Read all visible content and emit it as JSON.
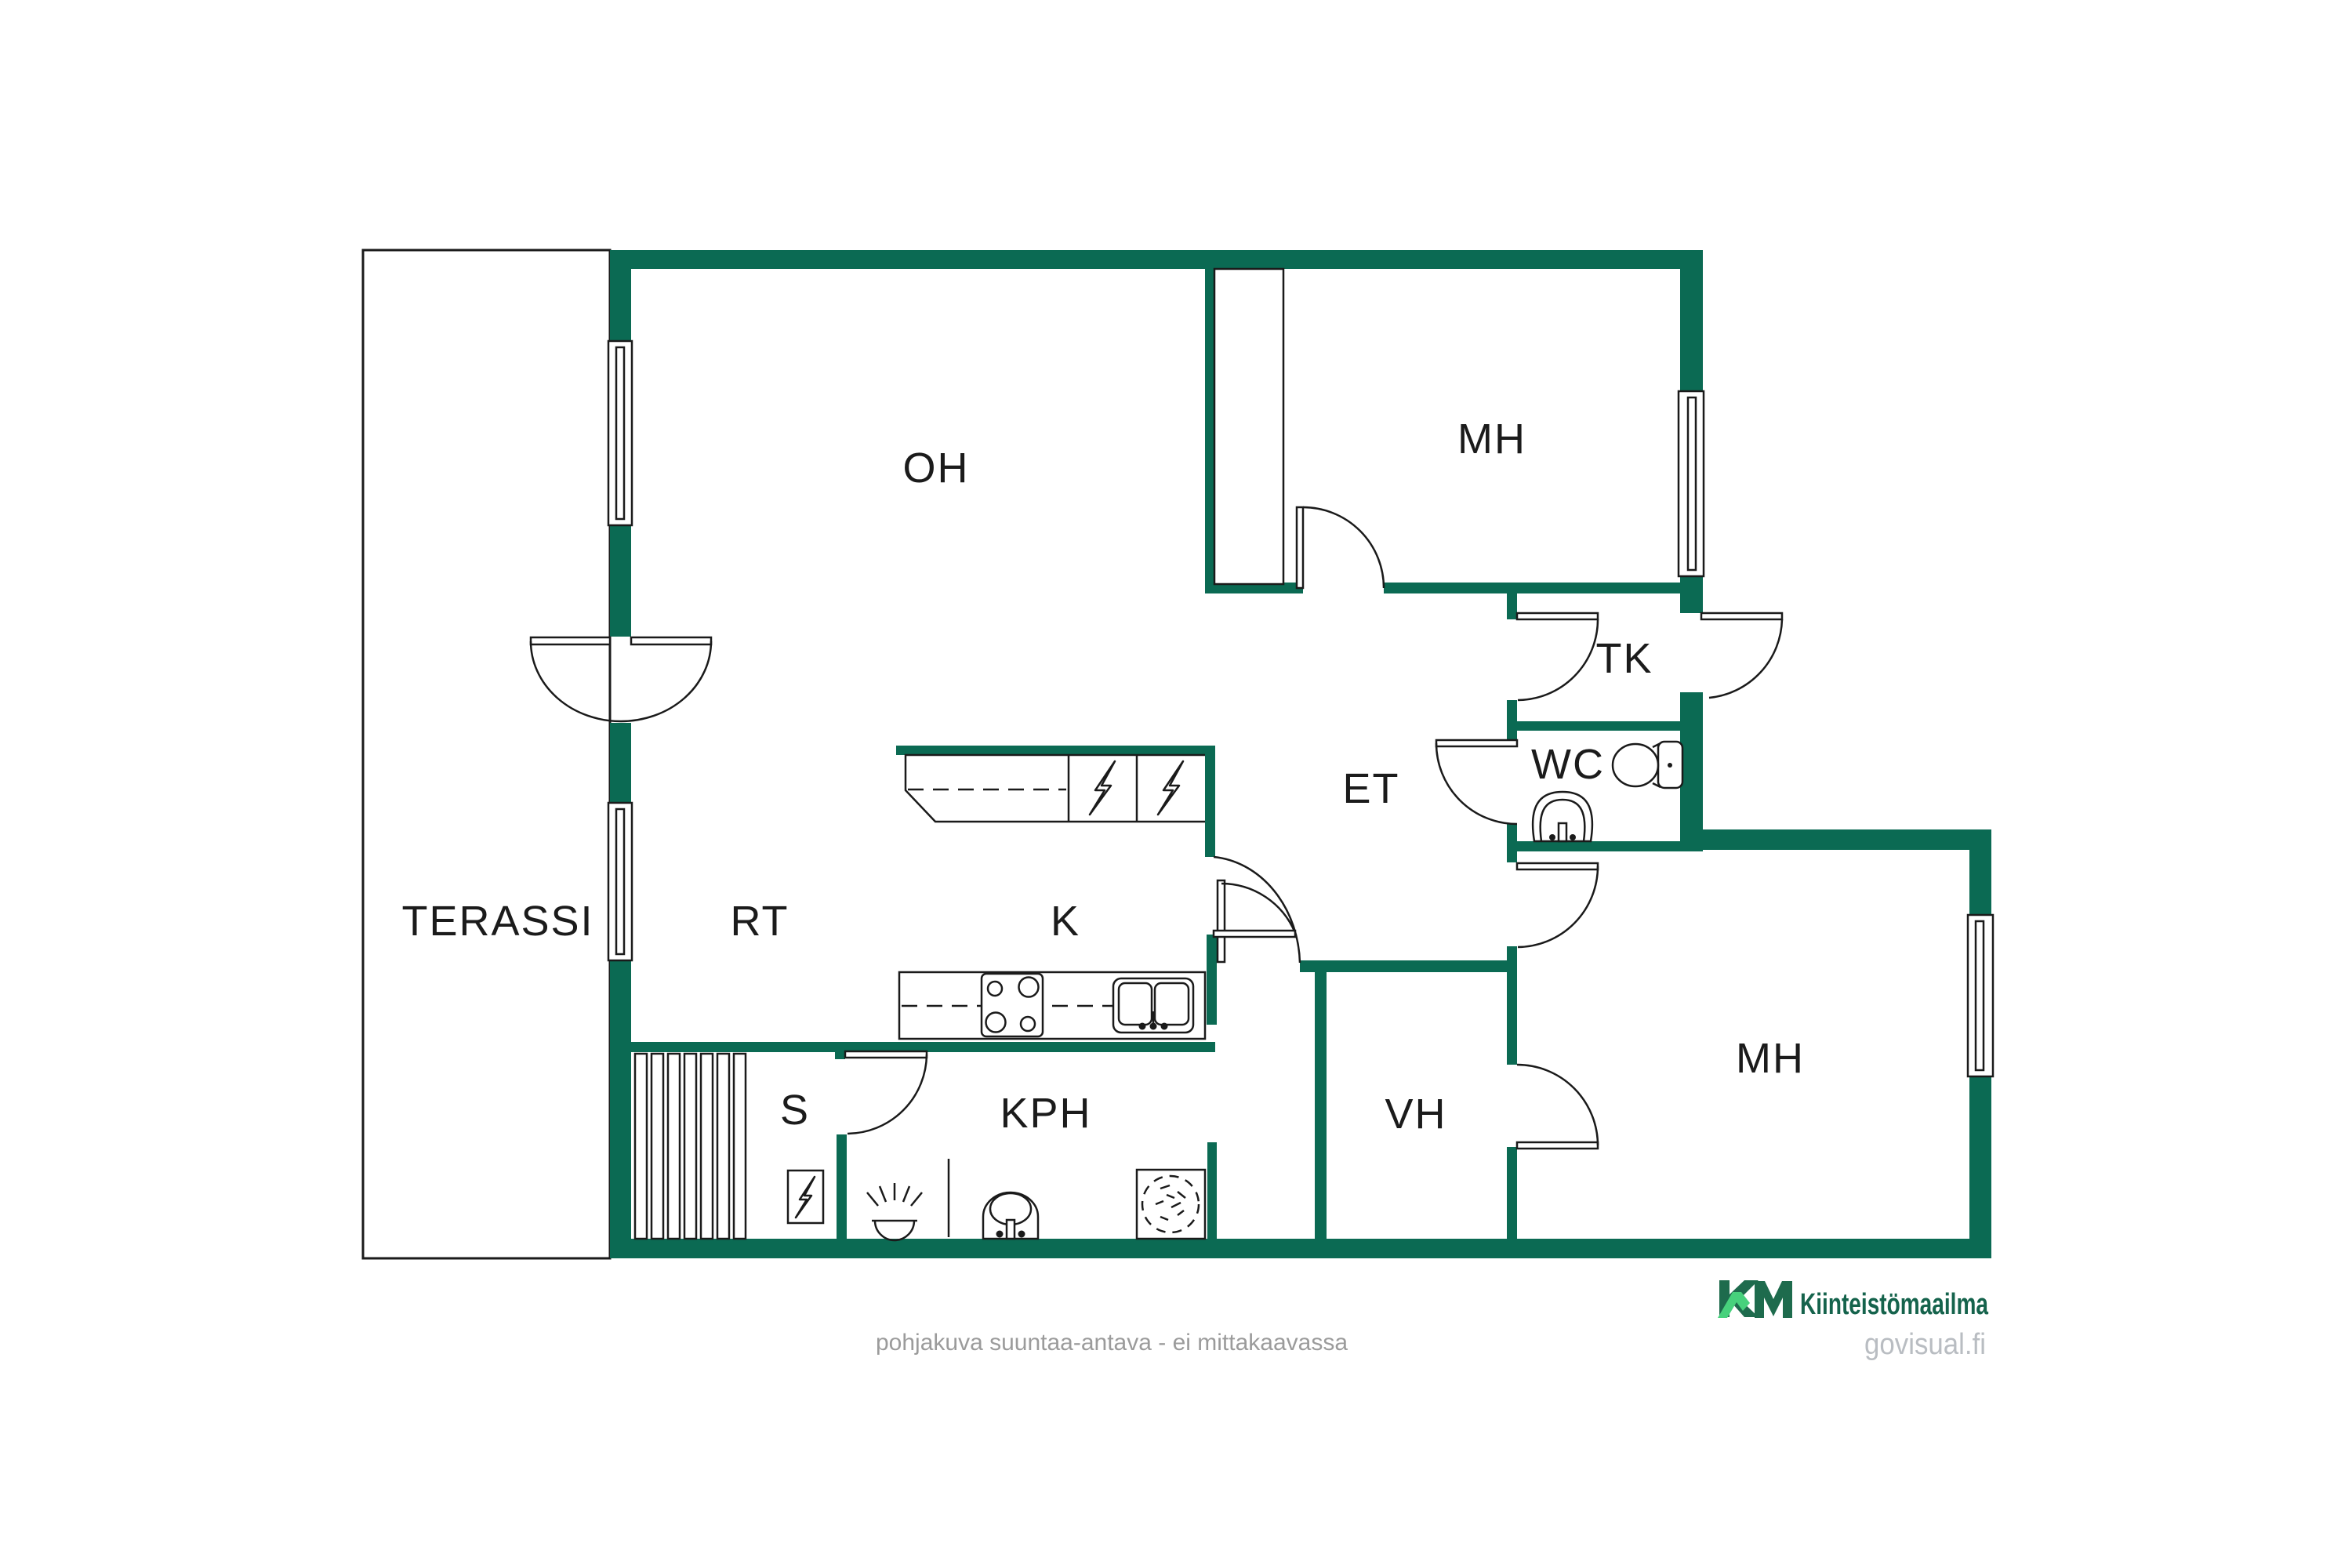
{
  "colors": {
    "wall": "#0b6a53",
    "line": "#1a1a1a",
    "label_text": "#1b1b1b",
    "disclaimer_text": "#9b9b9b",
    "brand_green_dark": "#1e6b4d",
    "brand_green_light": "#47d17c",
    "brand_text_green": "#15634c",
    "website_text": "#b9bdc2",
    "background": "#ffffff"
  },
  "rooms": {
    "terassi": "TERASSI",
    "oh": "OH",
    "mh_top": "MH",
    "tk": "TK",
    "et": "ET",
    "wc": "WC",
    "rt": "RT",
    "k": "K",
    "s": "S",
    "kph": "KPH",
    "vh": "VH",
    "mh_bottom": "MH"
  },
  "icons": {
    "fridge": "lightning-bolt-square",
    "freezer": "lightning-bolt-square",
    "sauna_stove": "lightning-bolt-square",
    "stove": "four-burner-cooktop",
    "kitchen_sink": "double-basin-sink",
    "toilet": "toilet-seat-with-tank",
    "wc_washbasin": "round-basin-with-tap",
    "kph_washbasin": "round-basin-with-tap",
    "washing_machine": "dashed-circle-square",
    "floor_light": "half-dome-with-rays",
    "shower_rail": "vertical-pole",
    "sauna_benches": "plank-stripes"
  },
  "footer": {
    "disclaimer": "pohjakuva suuntaa-antava - ei mittakaavassa",
    "logo_mark": "KM",
    "brand": "Kiinteistömaailma",
    "website": "govisual.fi"
  }
}
